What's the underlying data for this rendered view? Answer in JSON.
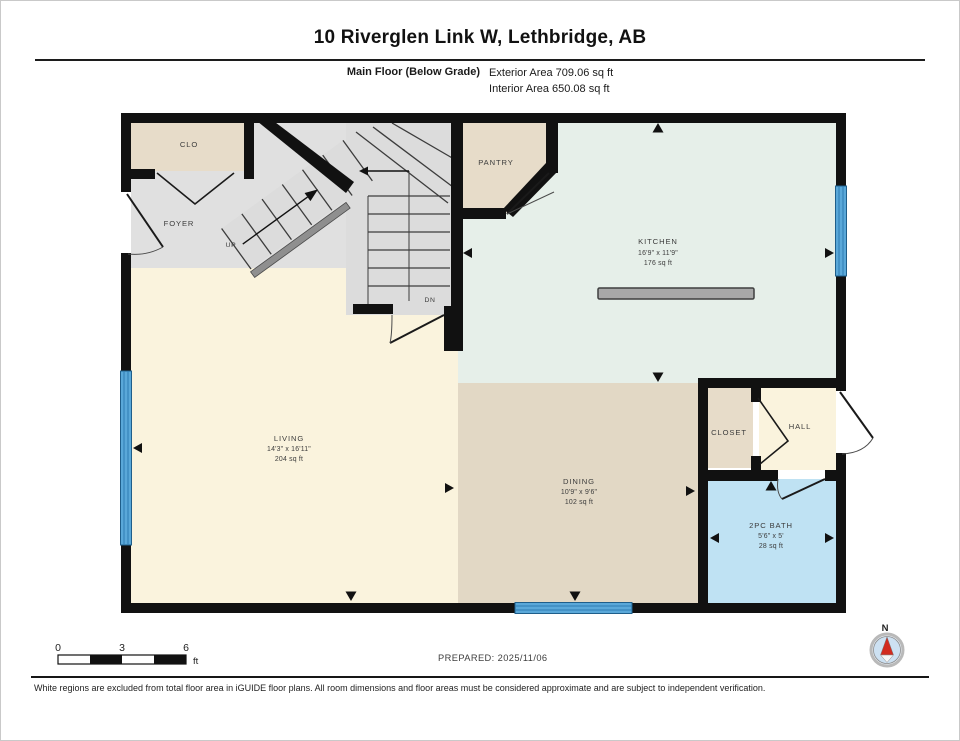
{
  "header": {
    "title": "10 Riverglen Link W, Lethbridge, AB",
    "floor_label": "Main Floor (Below Grade)",
    "exterior_area": "Exterior Area 709.06 sq ft",
    "interior_area": "Interior Area 650.08 sq ft"
  },
  "rooms": {
    "clo": {
      "name": "CLO"
    },
    "foyer": {
      "name": "FOYER"
    },
    "pantry": {
      "name": "PANTRY"
    },
    "kitchen": {
      "name": "KITCHEN",
      "dims": "16'9\" x 11'9\"",
      "area": "176 sq ft"
    },
    "living": {
      "name": "LIVING",
      "dims": "14'3\" x 16'11\"",
      "area": "204 sq ft"
    },
    "dining": {
      "name": "DINING",
      "dims": "10'9\" x 9'6\"",
      "area": "102 sq ft"
    },
    "closet": {
      "name": "CLOSET"
    },
    "hall": {
      "name": "HALL"
    },
    "bath": {
      "name": "2PC BATH",
      "dims": "5'6\" x 5'",
      "area": "28 sq ft"
    }
  },
  "stairs": {
    "up_label": "UP",
    "down_label": "DN"
  },
  "scale_bar": {
    "ticks": [
      "0",
      "3",
      "6"
    ],
    "unit": "ft"
  },
  "compass": {
    "north_label": "N"
  },
  "footer": {
    "prepared": "PREPARED: 2025/11/06",
    "disclaimer": "White regions are excluded from total floor area in iGUIDE floor plans. All room dimensions and floor areas must be considered approximate and are subject to independent verification."
  },
  "colors": {
    "wall": "#111111",
    "cream": "#faf3dd",
    "gray": "#e0e0e0",
    "stair_gray": "#dcdcdc",
    "beige": "#e7dcc9",
    "dining_beige": "#e2d8c5",
    "kitchen_mint": "#e6efe9",
    "bath_blue": "#bfe2f3",
    "window_blue": "#5aa8d9",
    "island_gray": "#a8a8a8",
    "needle_red": "#d22b1f"
  }
}
